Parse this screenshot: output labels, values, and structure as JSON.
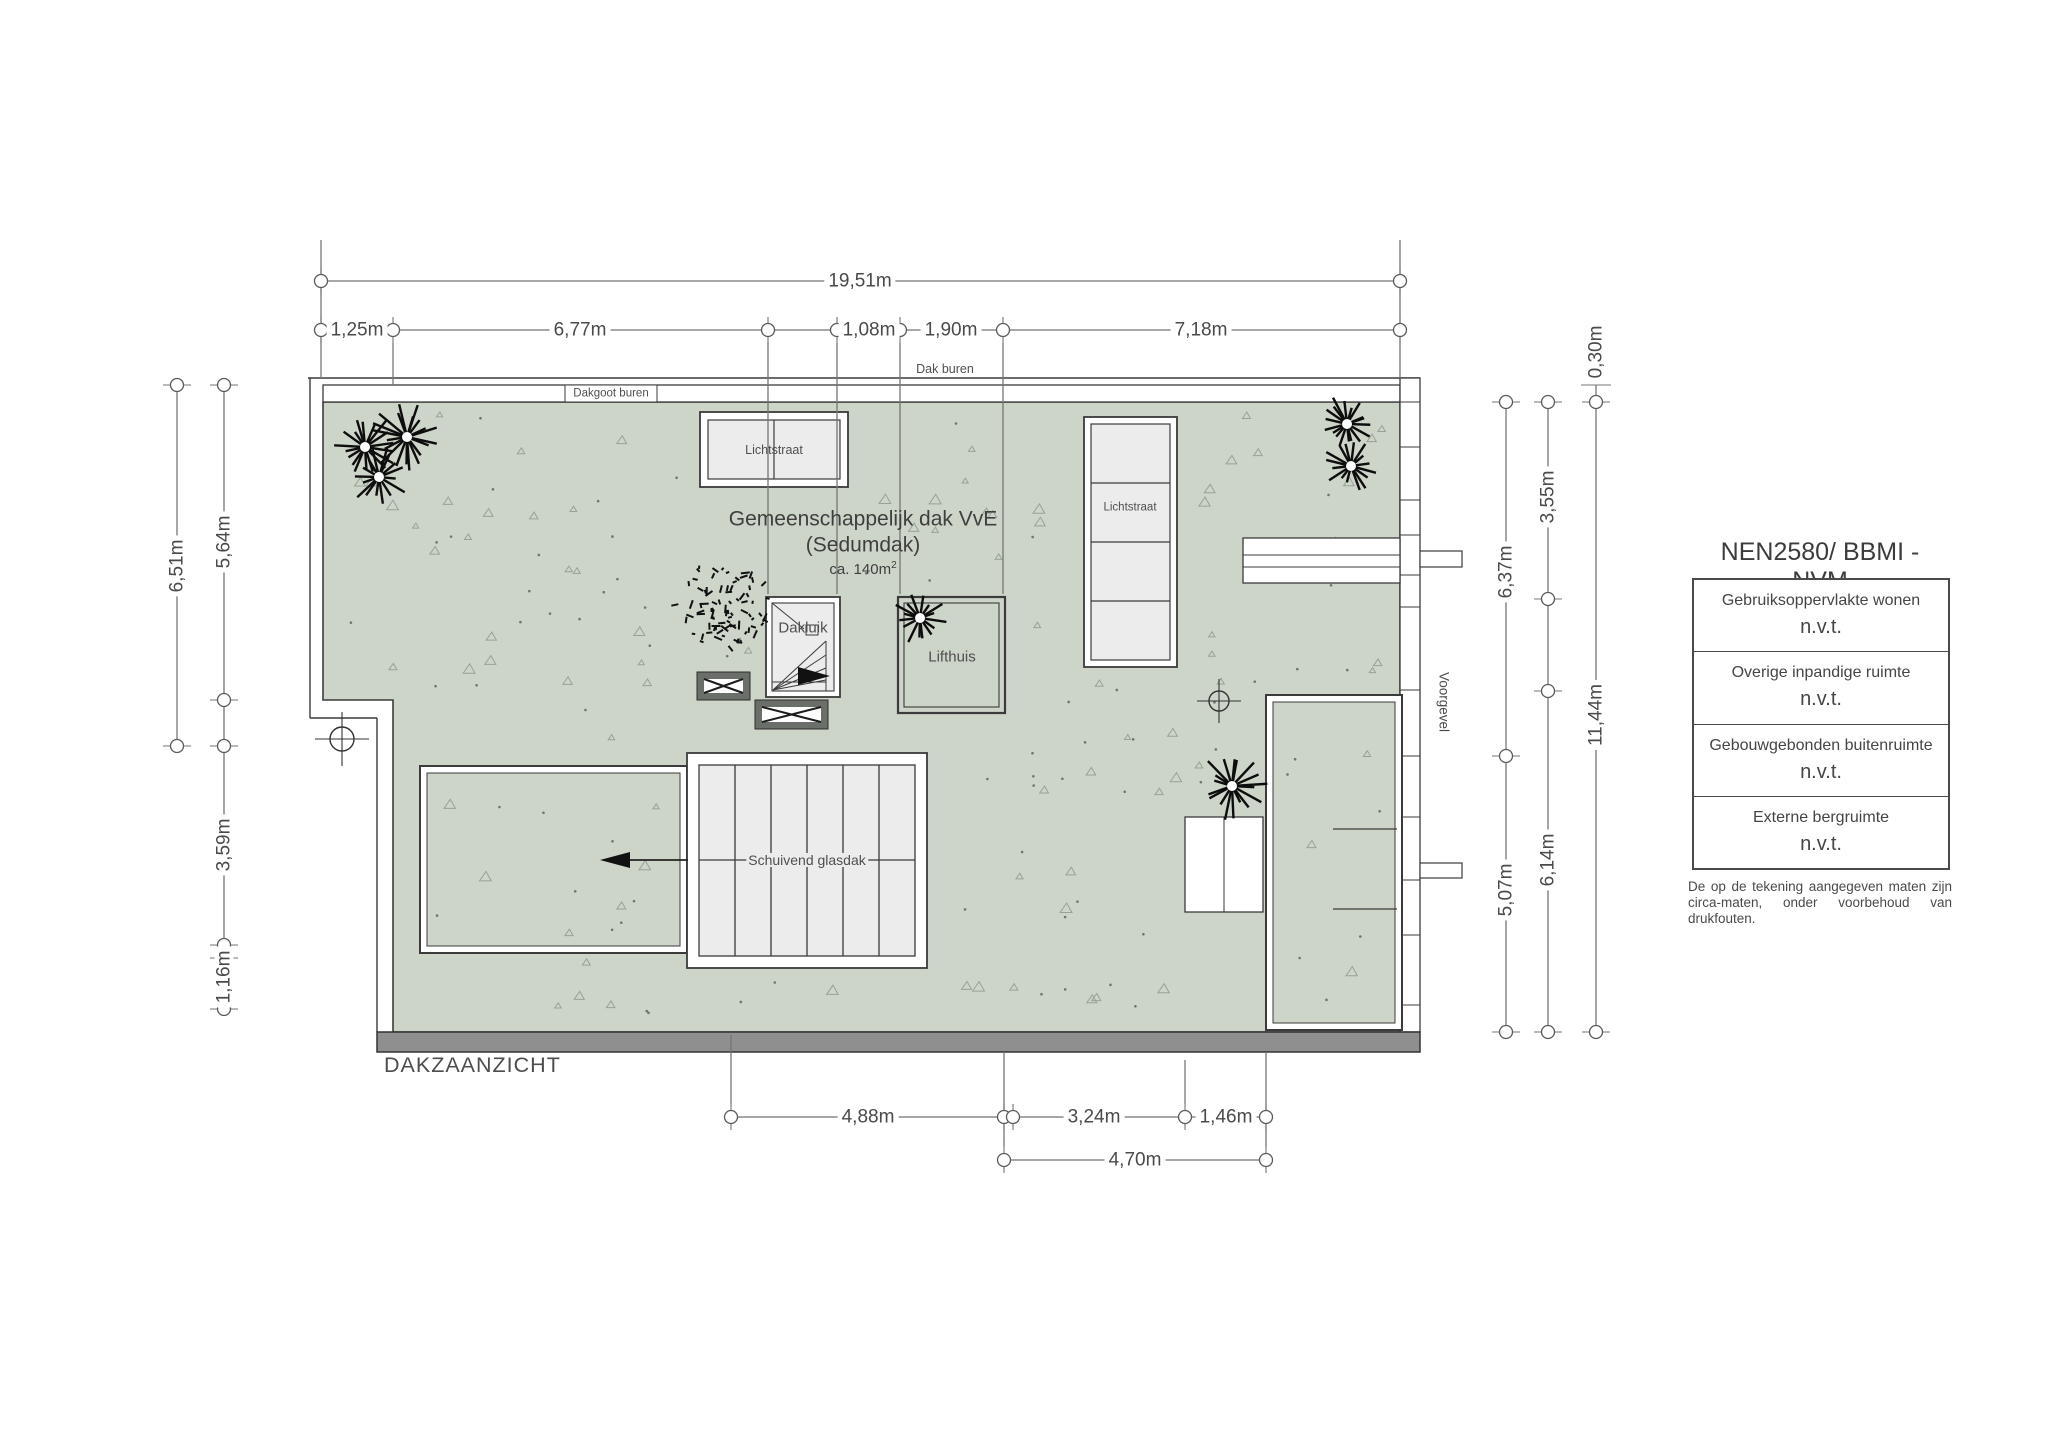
{
  "title": "DAKZAANZICHT",
  "roof": {
    "line1": "Gemeenschappelijk dak VvE",
    "line2": "(Sedumdak)",
    "area_prefix": "ca. 140m",
    "area_sup": "2"
  },
  "labels": {
    "dak_buren": "Dak buren",
    "dakgoot_buren": "Dakgoot buren",
    "lichtstraat_top": "Lichtstraat",
    "lichtstraat_right": "Lichtstraat",
    "dakluik": "Dakluik",
    "lifthuis": "Lifthuis",
    "schuivend_glasdak": "Schuivend glasdak",
    "voorgevel": "Voorgevel"
  },
  "dims": {
    "total_width": "19,51m",
    "top": [
      "1,25m",
      "6,77m",
      "1,08m",
      "1,90m",
      "7,18m"
    ],
    "left": [
      "6,51m",
      "5,64m",
      "3,59m",
      "1,16m"
    ],
    "right": [
      "0,30m",
      "3,55m",
      "6,37m",
      "6,14m",
      "5,07m",
      "11,44m"
    ],
    "bottom": [
      "4,88m",
      "3,24m",
      "1,46m",
      "4,70m"
    ]
  },
  "legend": {
    "title": "NEN2580/ BBMI - NVM",
    "rows": [
      {
        "label": "Gebruiksoppervlakte wonen",
        "value": "n.v.t."
      },
      {
        "label": "Overige inpandige ruimte",
        "value": "n.v.t."
      },
      {
        "label": "Gebouwgebonden buitenruimte",
        "value": "n.v.t."
      },
      {
        "label": "Externe bergruimte",
        "value": "n.v.t."
      }
    ],
    "disclaimer": "De op de tekening aangegeven maten zijn circa-maten, onder voorbehoud van drukfouten."
  },
  "colors": {
    "sedum_green": "#cdd4c8",
    "glass_gray": "#ececec",
    "outline": "#3b3b3b",
    "dimension_gray": "#757575",
    "facade_bar": "#8f8f8f"
  }
}
